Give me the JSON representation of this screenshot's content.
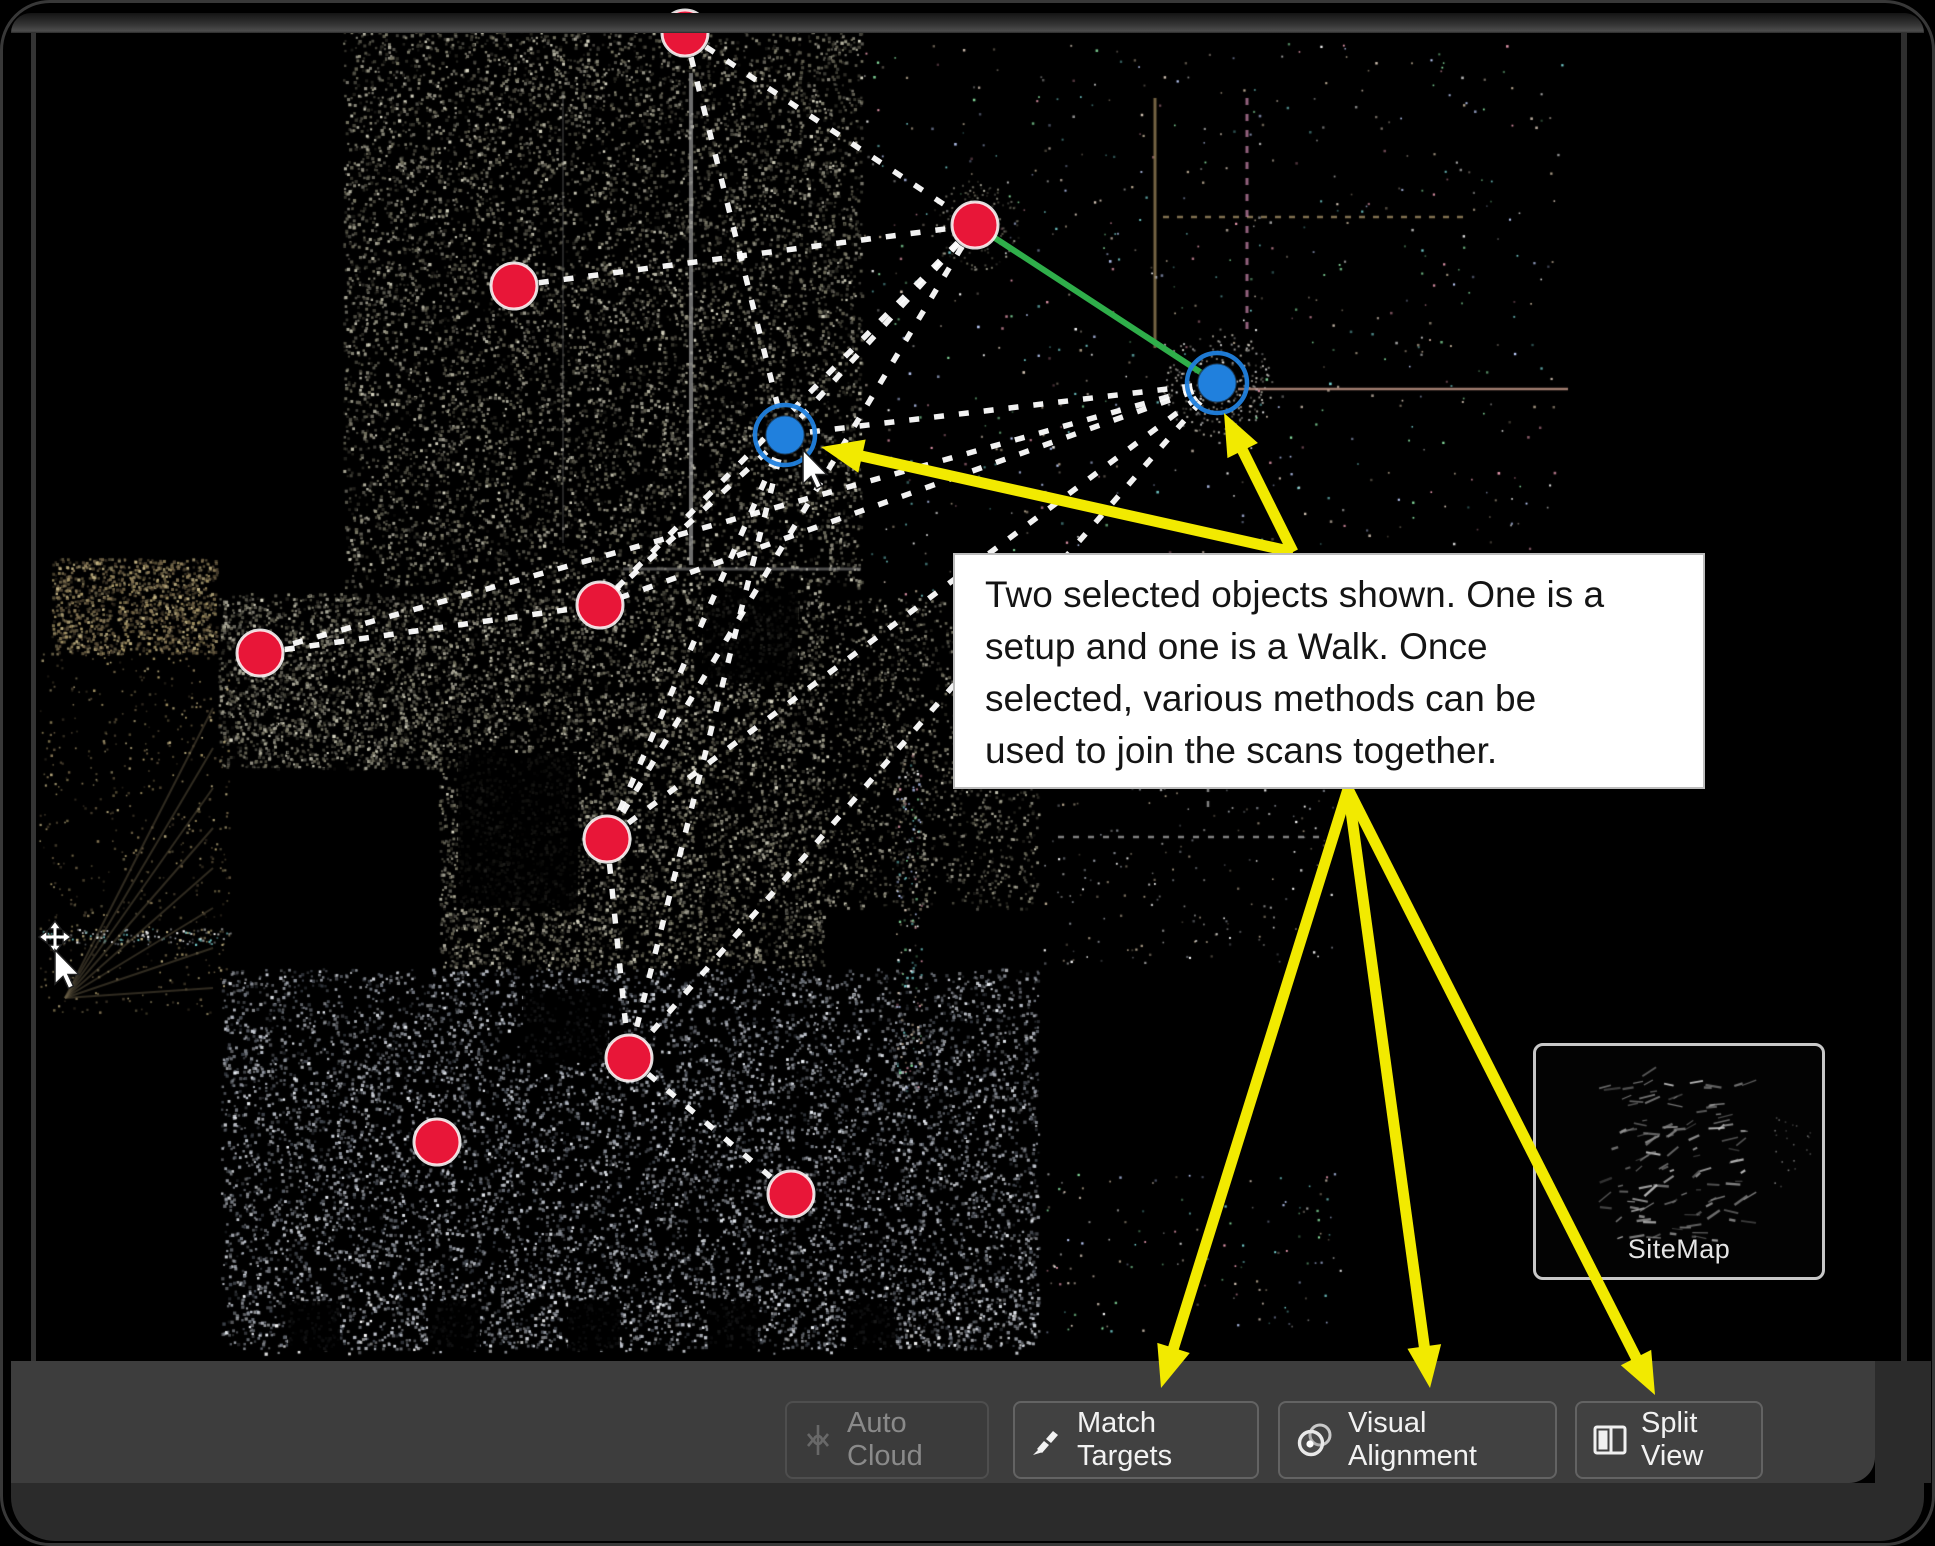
{
  "canvas_view": {
    "annotation": {
      "lines": [
        "Two selected objects shown. One is a",
        "setup and one is a Walk. Once",
        "selected, various methods can be",
        "used to join the scans together."
      ]
    },
    "markers": {
      "setups": [
        {
          "id": "A",
          "x": 682,
          "y": 30
        },
        {
          "id": "B",
          "x": 511,
          "y": 283
        },
        {
          "id": "C",
          "x": 972,
          "y": 222
        },
        {
          "id": "D",
          "x": 257,
          "y": 650
        },
        {
          "id": "E",
          "x": 597,
          "y": 602
        },
        {
          "id": "F",
          "x": 604,
          "y": 836
        },
        {
          "id": "G",
          "x": 626,
          "y": 1055
        },
        {
          "id": "H",
          "x": 434,
          "y": 1139
        },
        {
          "id": "I",
          "x": 788,
          "y": 1191
        }
      ],
      "selected": [
        {
          "id": "L",
          "x": 782,
          "y": 432
        },
        {
          "id": "R",
          "x": 1214,
          "y": 380
        }
      ]
    },
    "connections": {
      "dashed": [
        [
          "A",
          "C"
        ],
        [
          "A",
          "L"
        ],
        [
          "B",
          "C"
        ],
        [
          "C",
          "L"
        ],
        [
          "C",
          "E"
        ],
        [
          "C",
          "F"
        ],
        [
          "R",
          "L"
        ],
        [
          "R",
          "D"
        ],
        [
          "R",
          "E"
        ],
        [
          "R",
          "F"
        ],
        [
          "R",
          "G"
        ],
        [
          "L",
          "E"
        ],
        [
          "L",
          "F"
        ],
        [
          "L",
          "G"
        ],
        [
          "D",
          "E"
        ],
        [
          "F",
          "G"
        ],
        [
          "G",
          "I"
        ]
      ],
      "solid_green": [
        "C",
        "R"
      ]
    },
    "callout_arrows": {
      "to_selection": {
        "origin": [
          1290,
          549
        ],
        "tips": [
          [
            818,
            444
          ],
          [
            1221,
            410
          ]
        ]
      },
      "to_buttons": {
        "origin": [
          1345,
          786
        ],
        "tips": [
          [
            1158,
            1385
          ],
          [
            1427,
            1385
          ],
          [
            1652,
            1392
          ]
        ]
      }
    },
    "cursors": [
      {
        "type": "pointer",
        "x": 800,
        "y": 447
      },
      {
        "type": "pan",
        "x": 52,
        "y": 947
      }
    ],
    "colors": {
      "setup_marker": "#e81638",
      "selected_marker": "#2080dd",
      "green_link": "#2fae4a",
      "dashed_link": "#ffffff",
      "callout_arrow": "#f2ea00"
    }
  },
  "sitemap": {
    "label": "SiteMap"
  },
  "toolbar": {
    "buttons": [
      {
        "label": "Auto Cloud",
        "icon": "auto-cloud-icon",
        "disabled": true
      },
      {
        "label": "Match Targets",
        "icon": "match-targets-icon",
        "disabled": false
      },
      {
        "label": "Visual Alignment",
        "icon": "visual-alignment-icon",
        "disabled": false
      },
      {
        "label": "Split View",
        "icon": "split-view-icon",
        "disabled": false
      }
    ]
  }
}
